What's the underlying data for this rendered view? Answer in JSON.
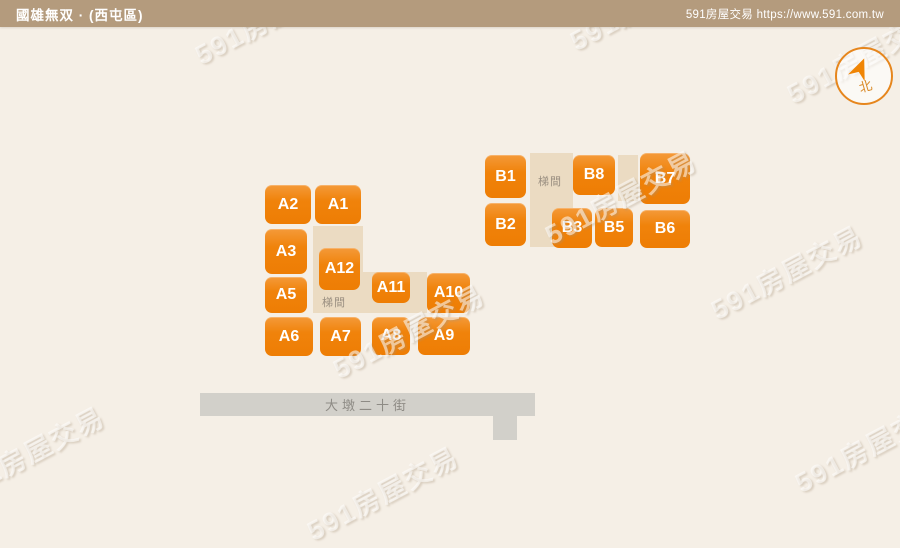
{
  "header": {
    "title": "國雄無双 · (西屯區)",
    "site": "591房屋交易 https://www.591.com.tw"
  },
  "compass": {
    "label": "北"
  },
  "watermark": {
    "text": "591房屋交易",
    "positions": [
      {
        "x": 270,
        "y": 16
      },
      {
        "x": 645,
        "y": 2
      },
      {
        "x": 862,
        "y": 55
      },
      {
        "x": 620,
        "y": 196
      },
      {
        "x": 408,
        "y": 330
      },
      {
        "x": 786,
        "y": 271
      },
      {
        "x": 28,
        "y": 452
      },
      {
        "x": 382,
        "y": 492
      },
      {
        "x": 870,
        "y": 444
      }
    ]
  },
  "map": {
    "stair_label": "梯間",
    "stair_areas": [
      {
        "x": 313,
        "y": 226,
        "w": 50,
        "h": 86
      },
      {
        "x": 313,
        "y": 272,
        "w": 114,
        "h": 41
      },
      {
        "x": 530,
        "y": 153,
        "w": 43,
        "h": 94
      },
      {
        "x": 618,
        "y": 155,
        "w": 20,
        "h": 46
      }
    ],
    "stair_labels": [
      {
        "x": 322,
        "y": 294
      },
      {
        "x": 538,
        "y": 173
      }
    ],
    "units": [
      {
        "id": "A2",
        "x": 265,
        "y": 185,
        "w": 46,
        "h": 39
      },
      {
        "id": "A1",
        "x": 315,
        "y": 185,
        "w": 46,
        "h": 39
      },
      {
        "id": "A3",
        "x": 265,
        "y": 229,
        "w": 42,
        "h": 45
      },
      {
        "id": "A12",
        "x": 319,
        "y": 248,
        "w": 41,
        "h": 42
      },
      {
        "id": "A5",
        "x": 265,
        "y": 277,
        "w": 42,
        "h": 36
      },
      {
        "id": "A11",
        "x": 372,
        "y": 272,
        "w": 38,
        "h": 31
      },
      {
        "id": "A10",
        "x": 427,
        "y": 273,
        "w": 43,
        "h": 40
      },
      {
        "id": "A6",
        "x": 265,
        "y": 317,
        "w": 48,
        "h": 39
      },
      {
        "id": "A7",
        "x": 320,
        "y": 317,
        "w": 41,
        "h": 39
      },
      {
        "id": "A8",
        "x": 372,
        "y": 317,
        "w": 38,
        "h": 38
      },
      {
        "id": "A9",
        "x": 418,
        "y": 317,
        "w": 52,
        "h": 38
      },
      {
        "id": "B1",
        "x": 485,
        "y": 155,
        "w": 41,
        "h": 43
      },
      {
        "id": "B2",
        "x": 485,
        "y": 203,
        "w": 41,
        "h": 43
      },
      {
        "id": "B8",
        "x": 573,
        "y": 155,
        "w": 42,
        "h": 40
      },
      {
        "id": "B7",
        "x": 640,
        "y": 153,
        "w": 50,
        "h": 51
      },
      {
        "id": "B3",
        "x": 552,
        "y": 208,
        "w": 40,
        "h": 40
      },
      {
        "id": "B5",
        "x": 595,
        "y": 208,
        "w": 38,
        "h": 39
      },
      {
        "id": "B6",
        "x": 640,
        "y": 210,
        "w": 50,
        "h": 38
      }
    ],
    "street": {
      "name": "大墩二十街",
      "bar": {
        "x": 200,
        "y": 393,
        "w": 335,
        "h": 23
      },
      "stub": {
        "x": 493,
        "y": 416,
        "w": 24,
        "h": 24
      }
    }
  },
  "colors": {
    "unit_orange": "#F0830B",
    "stair_beige": "#EBDBC2",
    "street_gray": "#D2D0CA",
    "header_tan": "#B49B7D",
    "compass_orange": "#E6861D",
    "background": "#F5EFE6"
  }
}
